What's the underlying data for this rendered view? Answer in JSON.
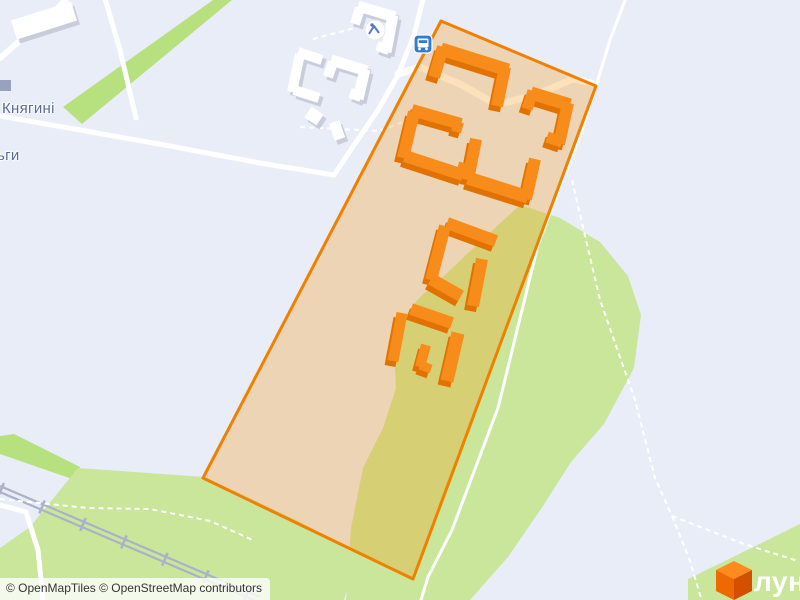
{
  "attribution": {
    "text": "© OpenMapTiles © OpenStreetMap contributors"
  },
  "street_label": {
    "line1": "Княгині",
    "line2": "ьги",
    "full_name": "Княгині Ольги"
  },
  "logo": {
    "text": "лун",
    "cube_colors": {
      "top": "#FF8B1F",
      "left": "#EE6A00",
      "right": "#D35000"
    }
  },
  "colors": {
    "background": "#E9EDF8",
    "road": "#FFFFFF",
    "green_bright": "#B7E07E",
    "green_light": "#C9E69B",
    "railway": "#ABB1C7",
    "highlight_fill": "#F59C1A",
    "highlight_fill_opacity": 0.3,
    "highlight_stroke": "#F08000",
    "building_orange": "#F78C1B",
    "building_orange_shadow": "#E17200",
    "building_white": "#FFFFFF",
    "building_white_shadow": "#C9CDDB",
    "poi_gray": "#98A1BE",
    "bus_blue": "#2F7CD0",
    "playground_blue": "#5578C8"
  },
  "geometry": {
    "greens": [
      {
        "name": "tree-row-area",
        "bright": true,
        "points": [
          [
            213,
            0
          ],
          [
            232,
            0
          ],
          [
            82,
            124
          ],
          [
            63,
            107
          ]
        ]
      },
      {
        "name": "green-area-right",
        "bright": false,
        "points": [
          [
            520,
            205
          ],
          [
            560,
            218
          ],
          [
            600,
            242
          ],
          [
            628,
            276
          ],
          [
            641,
            315
          ],
          [
            634,
            368
          ],
          [
            604,
            424
          ],
          [
            571,
            462
          ],
          [
            543,
            506
          ],
          [
            508,
            557
          ],
          [
            470,
            600
          ],
          [
            346,
            600
          ],
          [
            351,
            528
          ],
          [
            363,
            468
          ],
          [
            383,
            428
          ],
          [
            396,
            388
          ],
          [
            394,
            352
          ],
          [
            400,
            323
          ],
          [
            418,
            299
          ],
          [
            446,
            274
          ],
          [
            483,
            239
          ]
        ]
      },
      {
        "name": "green-strip-nw",
        "bright": true,
        "points": [
          [
            0,
            436
          ],
          [
            14,
            434
          ],
          [
            80,
            467
          ],
          [
            75,
            480
          ],
          [
            0,
            454
          ]
        ]
      },
      {
        "name": "green-area-bottom-left",
        "bright": false,
        "points": [
          [
            0,
            548
          ],
          [
            30,
            527
          ],
          [
            78,
            468
          ],
          [
            205,
            477
          ],
          [
            298,
            521
          ],
          [
            358,
            552
          ],
          [
            344,
            600
          ],
          [
            0,
            600
          ]
        ]
      },
      {
        "name": "green-area-bottom-right",
        "bright": false,
        "points": [
          [
            688,
            579
          ],
          [
            733,
            557
          ],
          [
            800,
            524
          ],
          [
            800,
            600
          ],
          [
            688,
            600
          ]
        ]
      }
    ],
    "roads": [
      {
        "pts": [
          [
            424,
            -5
          ],
          [
            414,
            35
          ],
          [
            398,
            75
          ],
          [
            378,
            110
          ],
          [
            352,
            148
          ],
          [
            334,
            175
          ]
        ],
        "w": 5
      },
      {
        "pts": [
          [
            0,
            116
          ],
          [
            80,
            130
          ],
          [
            170,
            146
          ],
          [
            260,
            163
          ],
          [
            334,
            175
          ]
        ],
        "w": 5
      },
      {
        "pts": [
          [
            104,
            -5
          ],
          [
            120,
            50
          ],
          [
            136,
            118
          ]
        ],
        "w": 5
      },
      {
        "pts": [
          [
            0,
            58
          ],
          [
            30,
            32
          ],
          [
            58,
            8
          ],
          [
            70,
            -5
          ]
        ],
        "w": 6
      },
      {
        "pts": [
          [
            398,
            74
          ],
          [
            420,
            67
          ],
          [
            462,
            85
          ],
          [
            497,
            105
          ],
          [
            538,
            94
          ],
          [
            573,
            79
          ],
          [
            591,
            83
          ]
        ],
        "w": 7
      },
      {
        "pts": [
          [
            627,
            -5
          ],
          [
            610,
            40
          ],
          [
            596,
            86
          ],
          [
            583,
            128
          ],
          [
            538,
            245
          ],
          [
            498,
            408
          ],
          [
            452,
            530
          ],
          [
            428,
            577
          ],
          [
            421,
            600
          ]
        ],
        "w": 3
      },
      {
        "pts": [
          [
            0,
            505
          ],
          [
            26,
            512
          ],
          [
            38,
            550
          ],
          [
            43,
            600
          ]
        ],
        "w": 5
      }
    ],
    "dashed_paths": [
      {
        "pts": [
          [
            572,
            180
          ],
          [
            600,
            300
          ],
          [
            635,
            400
          ],
          [
            655,
            478
          ],
          [
            672,
            516
          ]
        ]
      },
      {
        "pts": [
          [
            672,
            516
          ],
          [
            689,
            558
          ],
          [
            701,
            598
          ]
        ]
      },
      {
        "pts": [
          [
            672,
            516
          ],
          [
            744,
            544
          ],
          [
            798,
            561
          ]
        ]
      },
      {
        "pts": [
          [
            313,
            39
          ],
          [
            397,
            17
          ]
        ]
      },
      {
        "pts": [
          [
            300,
            127
          ],
          [
            380,
            131
          ],
          [
            433,
            110
          ]
        ]
      },
      {
        "pts": [
          [
            0,
            499
          ],
          [
            88,
            508
          ],
          [
            150,
            509
          ],
          [
            210,
            521
          ],
          [
            255,
            541
          ]
        ]
      }
    ],
    "railway": {
      "pts": [
        [
          0,
          489
        ],
        [
          260,
          600
        ]
      ]
    },
    "highlight": {
      "points": [
        [
          441,
          21
        ],
        [
          596,
          86
        ],
        [
          413,
          579
        ],
        [
          203,
          478
        ]
      ]
    },
    "orange_buildings": [
      [
        441,
        49,
        508,
        70,
        13
      ],
      [
        443,
        47,
        434,
        77,
        12
      ],
      [
        505,
        67,
        497,
        106,
        12
      ],
      [
        531,
        93,
        570,
        105,
        13
      ],
      [
        533,
        91,
        527,
        109,
        11
      ],
      [
        568,
        103,
        559,
        144,
        12
      ],
      [
        562,
        142,
        547,
        137,
        11
      ],
      [
        412,
        110,
        461,
        124,
        12
      ],
      [
        414,
        112,
        403,
        158,
        12
      ],
      [
        405,
        156,
        463,
        175,
        12
      ],
      [
        459,
        122,
        456,
        132,
        10
      ],
      [
        461,
        173,
        464,
        163,
        10
      ],
      [
        476,
        139,
        468,
        180,
        12
      ],
      [
        468,
        178,
        528,
        197,
        13
      ],
      [
        526,
        199,
        535,
        159,
        12
      ],
      [
        447,
        223,
        496,
        241,
        12
      ],
      [
        445,
        226,
        431,
        280,
        12
      ],
      [
        431,
        279,
        461,
        296,
        12
      ],
      [
        482,
        259,
        473,
        306,
        12
      ],
      [
        411,
        309,
        452,
        323,
        12
      ],
      [
        402,
        313,
        393,
        361,
        11
      ],
      [
        426,
        345,
        420,
        367,
        10
      ],
      [
        420,
        365,
        431,
        369,
        9
      ],
      [
        458,
        333,
        447,
        381,
        13
      ]
    ],
    "white_buildings": [
      [
        358,
        6,
        395,
        17,
        11
      ],
      [
        393,
        15,
        386,
        52,
        11
      ],
      [
        389,
        50,
        377,
        46,
        10
      ],
      [
        360,
        8,
        355,
        24,
        10
      ],
      [
        331,
        60,
        367,
        71,
        11
      ],
      [
        365,
        69,
        358,
        99,
        11
      ],
      [
        361,
        97,
        350,
        93,
        10
      ],
      [
        333,
        62,
        328,
        77,
        10
      ],
      [
        298,
        52,
        322,
        60,
        10
      ],
      [
        300,
        54,
        292,
        92,
        10
      ],
      [
        294,
        90,
        319,
        98,
        10
      ],
      [
        308,
        112,
        320,
        120,
        13
      ],
      [
        334,
        122,
        340,
        139,
        11
      ],
      [
        14,
        30,
        74,
        11,
        20
      ]
    ],
    "poi_square": {
      "x": 0,
      "y": 80,
      "size": 11
    },
    "bus_stop": {
      "x": 414,
      "y": 35,
      "size": 18
    },
    "playground": {
      "cx": 375,
      "cy": 30,
      "r": 10
    }
  }
}
